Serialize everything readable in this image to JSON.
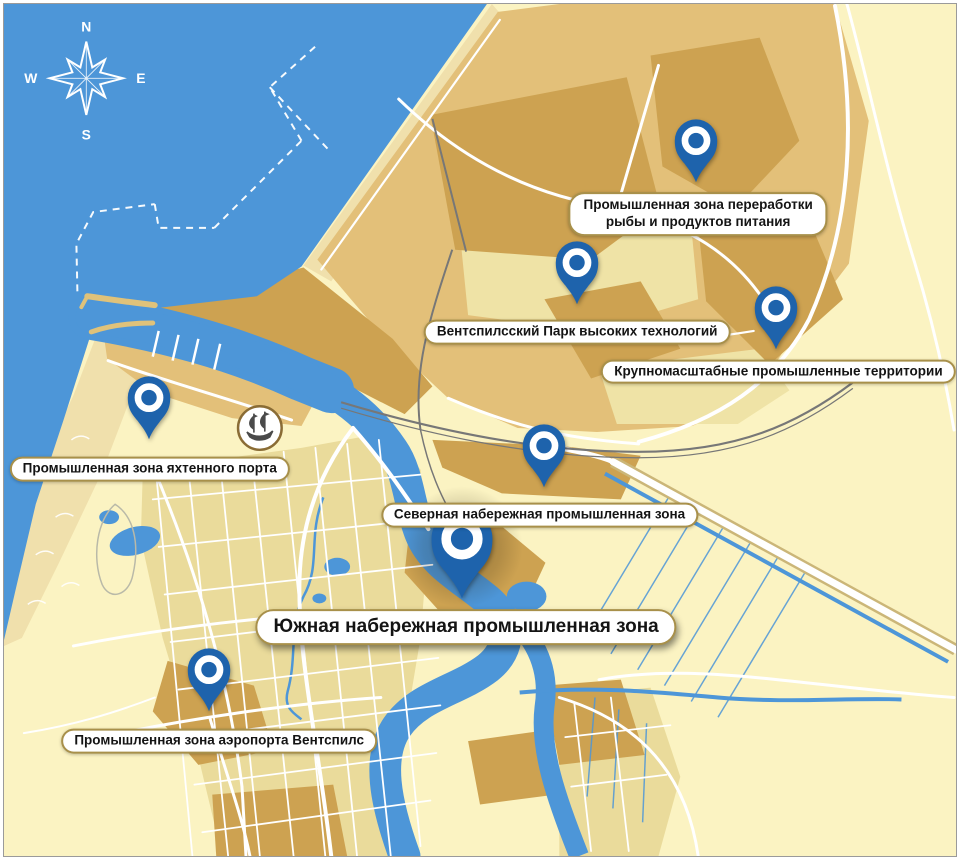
{
  "map": {
    "compass": {
      "north": "N",
      "east": "E",
      "south": "S",
      "west": "W"
    },
    "colors": {
      "water": "#4D96D8",
      "land": "#FBF3C2",
      "sand": "#F0E0AC",
      "city_block": "#EADB9B",
      "industrial": "#E3C079",
      "industrial_dark": "#CDA251",
      "industrial_light": "#EFE3A6",
      "road": "#FFFFFF",
      "road_casing": "#CBB678",
      "rail": "#777777",
      "pin": "#1E63AC",
      "label_border": "#A8904A",
      "label_text": "#141414"
    },
    "pins": [
      {
        "id": "fish-processing",
        "x": 698,
        "y": 182,
        "size": "normal",
        "label": {
          "x": 700,
          "y": 212,
          "size": "normal",
          "lines": [
            "Промышленная зона переработки",
            "рыбы и продуктов питания"
          ]
        }
      },
      {
        "id": "high-tech-park",
        "x": 578,
        "y": 305,
        "size": "normal",
        "label": {
          "x": 578,
          "y": 331,
          "size": "normal",
          "lines": [
            "Вентспилсский Парк высоких технологий"
          ]
        }
      },
      {
        "id": "large-scale-territories",
        "x": 778,
        "y": 350,
        "size": "normal",
        "label": {
          "x": 781,
          "y": 371,
          "size": "normal",
          "lines": [
            "Крупномасштабные промышленные территории"
          ]
        }
      },
      {
        "id": "yacht-port",
        "x": 146,
        "y": 441,
        "size": "normal",
        "label": {
          "x": 147,
          "y": 469,
          "size": "normal",
          "lines": [
            "Промышленная зона яхтенного порта"
          ]
        }
      },
      {
        "id": "north-embankment",
        "x": 545,
        "y": 490,
        "size": "normal",
        "label": {
          "x": 540,
          "y": 516,
          "size": "normal",
          "lines": [
            "Северная набережная промышленная зона"
          ]
        }
      },
      {
        "id": "south-embankment",
        "x": 462,
        "y": 603,
        "size": "large",
        "label": {
          "x": 466,
          "y": 629,
          "size": "large",
          "lines": [
            "Южная набережная промышленная зона"
          ]
        }
      },
      {
        "id": "airport",
        "x": 207,
        "y": 716,
        "size": "normal",
        "label": {
          "x": 217,
          "y": 744,
          "size": "normal",
          "lines": [
            "Промышленная зона аэропорта Вентспилс"
          ]
        }
      }
    ]
  }
}
